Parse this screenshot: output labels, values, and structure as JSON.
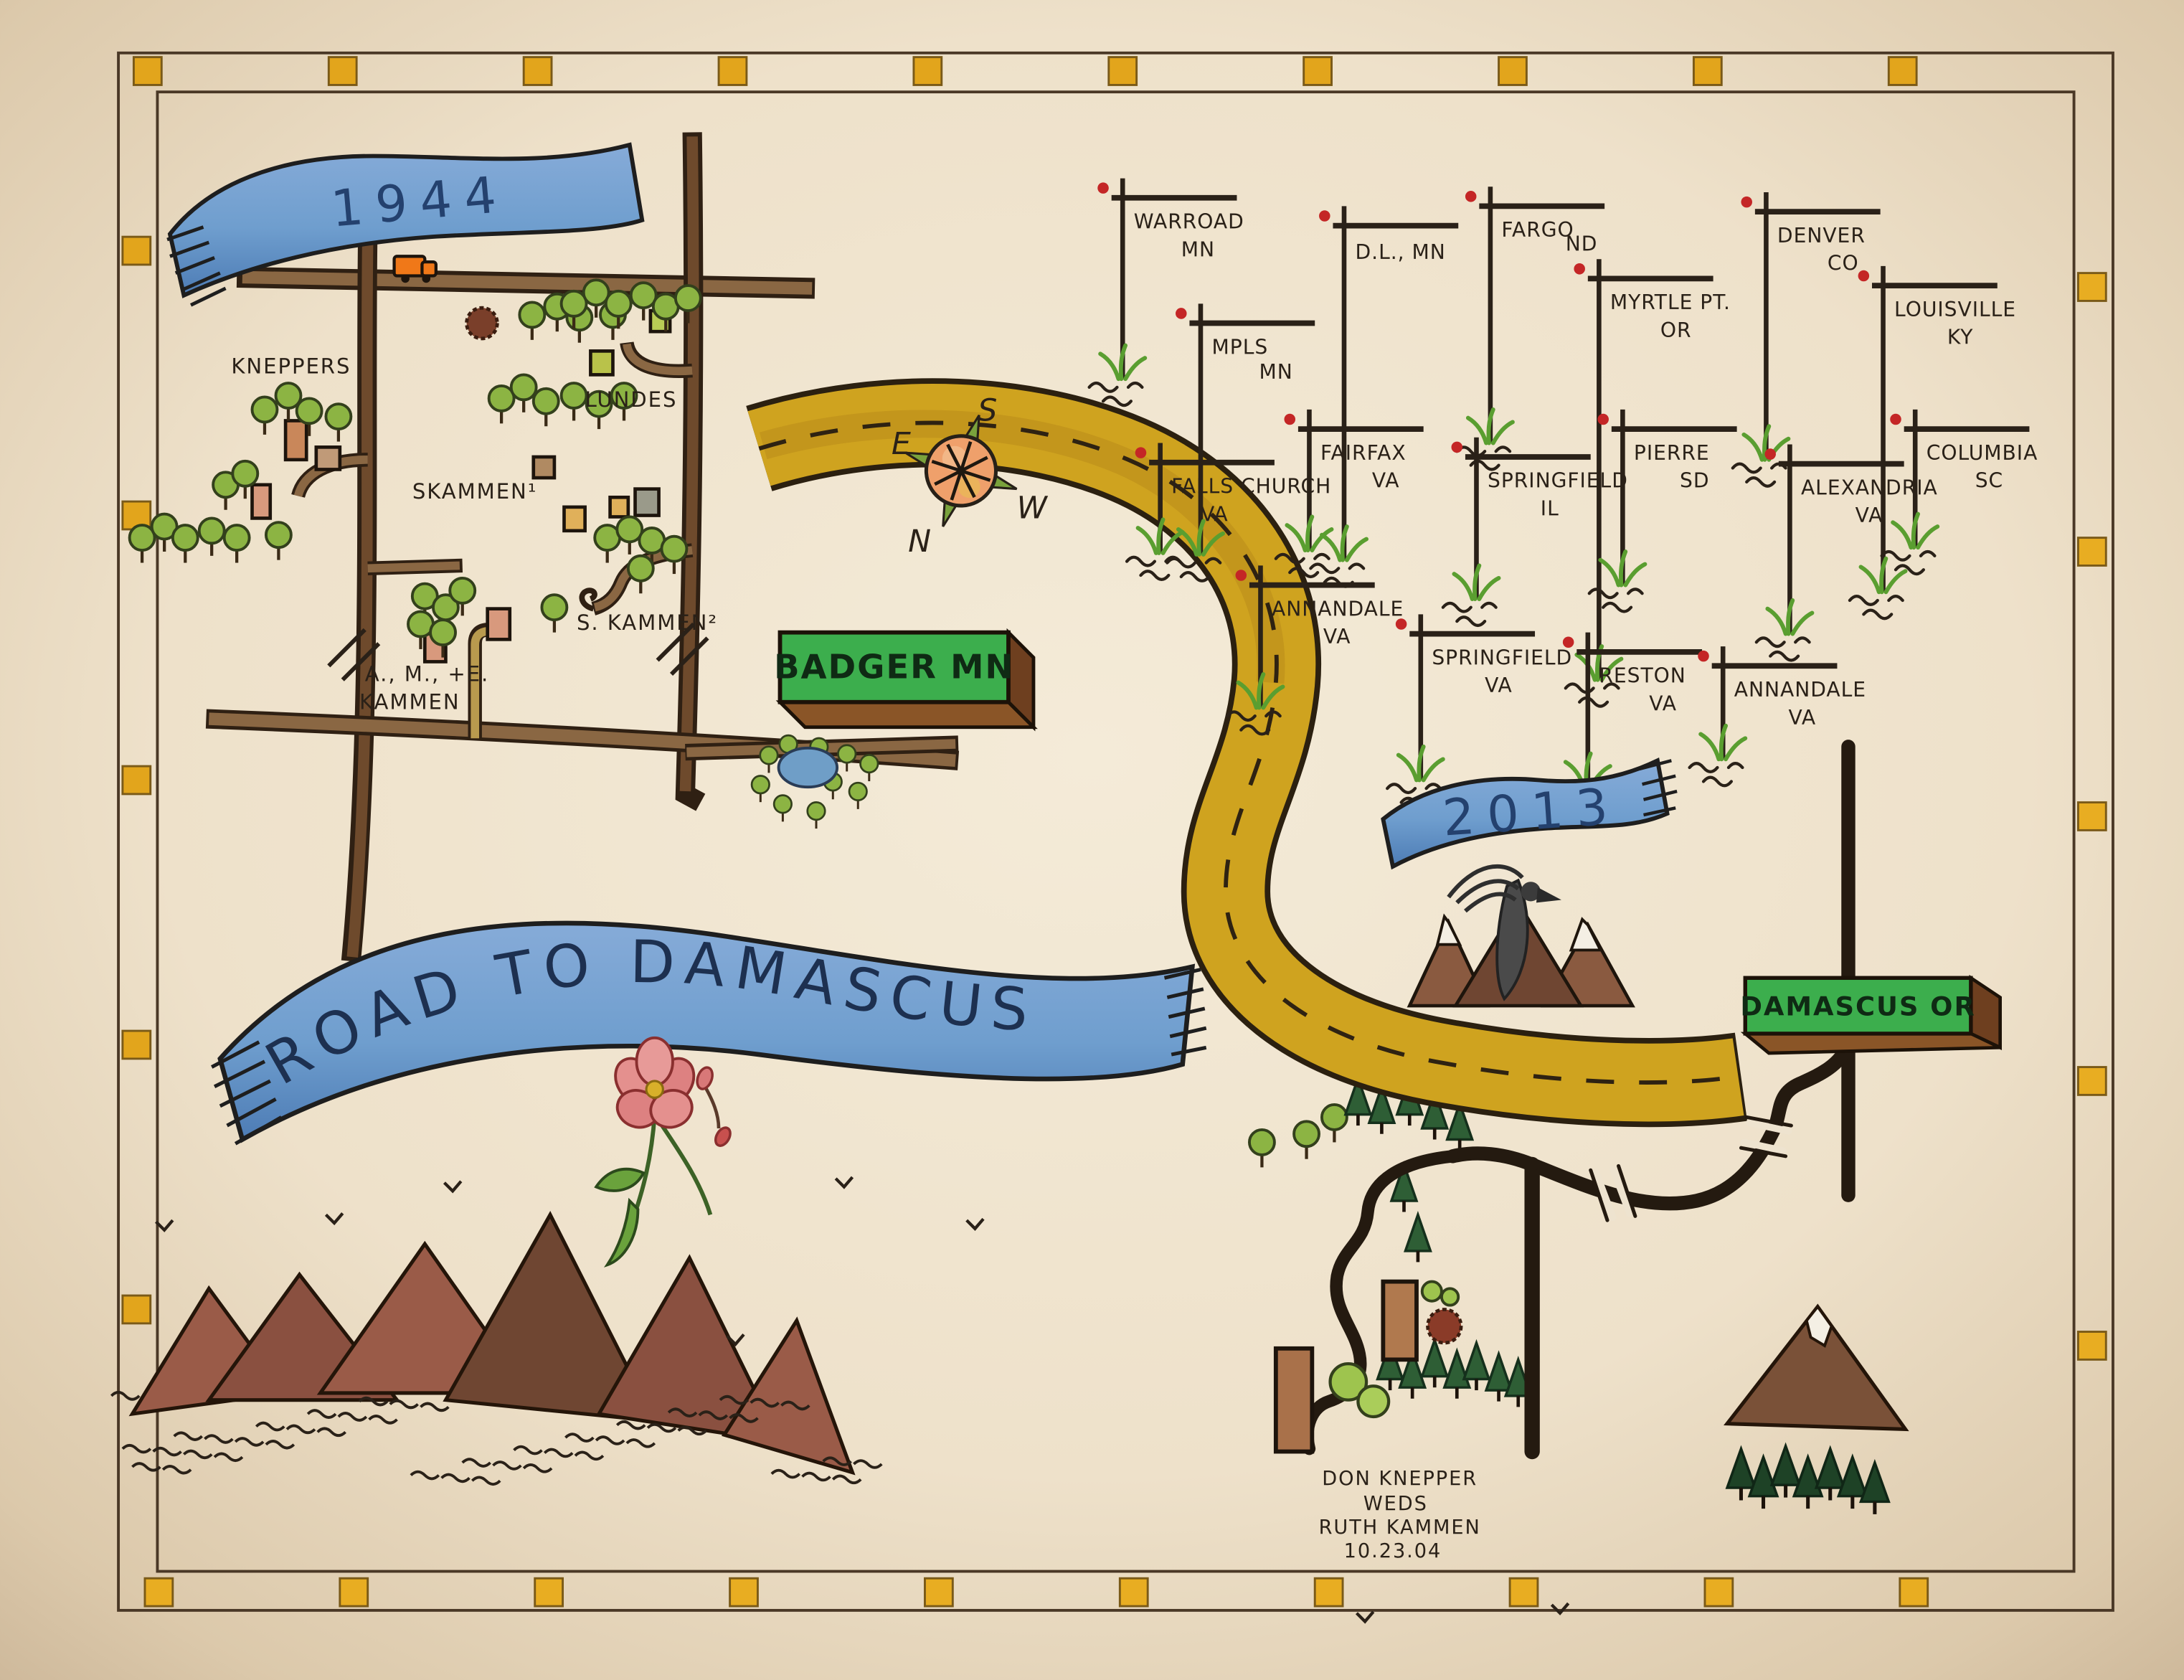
{
  "banners": {
    "year_start": "1944",
    "year_end": "2013",
    "title": "ROAD TO DAMASCUS"
  },
  "farm_labels": {
    "kneppers": "KNEPPERS",
    "skammen": "SKAMMEN¹",
    "lundes": "LUNDES",
    "s_kammen": "S. KAMMEN²",
    "ame_kammen_line1": "A., M., +E.",
    "ame_kammen_line2": "KAMMEN"
  },
  "signs": {
    "badger": "BADGER MN",
    "damascus": "DAMASCUS OR"
  },
  "compass": {
    "top": "S",
    "left": "E",
    "right": "W",
    "bottom": "N"
  },
  "signposts": [
    {
      "city": "WARROAD",
      "state": "MN"
    },
    {
      "city": "MPLS",
      "state": "MN"
    },
    {
      "city": "D.L., MN",
      "state": ""
    },
    {
      "city": "FARGO",
      "state": "ND"
    },
    {
      "city": "MYRTLE PT.",
      "state": "OR"
    },
    {
      "city": "DENVER",
      "state": "CO"
    },
    {
      "city": "LOUISVILLE",
      "state": "KY"
    },
    {
      "city": "FALLS CHURCH",
      "state": "VA"
    },
    {
      "city": "FAIRFAX",
      "state": "VA"
    },
    {
      "city": "SPRINGFIELD",
      "state": "IL"
    },
    {
      "city": "PIERRE",
      "state": "SD"
    },
    {
      "city": "ALEXANDRIA",
      "state": "VA"
    },
    {
      "city": "COLUMBIA",
      "state": "SC"
    },
    {
      "city": "ANNANDALE",
      "state": "VA"
    },
    {
      "city": "SPRINGFIELD",
      "state": "VA"
    },
    {
      "city": "RESTON",
      "state": "VA"
    },
    {
      "city": "ANNANDALE",
      "state": "VA"
    }
  ],
  "wedding_note": {
    "line1": "DON KNEPPER",
    "line2": "WEDS",
    "line3": "RUTH KAMMEN",
    "line4": "10.23.04"
  },
  "colors": {
    "paper": "#f0e6d2",
    "border_gold": "#e2a51c",
    "banner_blue": "#6f9ece",
    "road_yellow": "#d4a221",
    "road_brown": "#8a6743",
    "road_black": "#241a10",
    "sign_green": "#3cae4d",
    "mountain_red": "#9a5b48",
    "ink": "#2a2118"
  }
}
